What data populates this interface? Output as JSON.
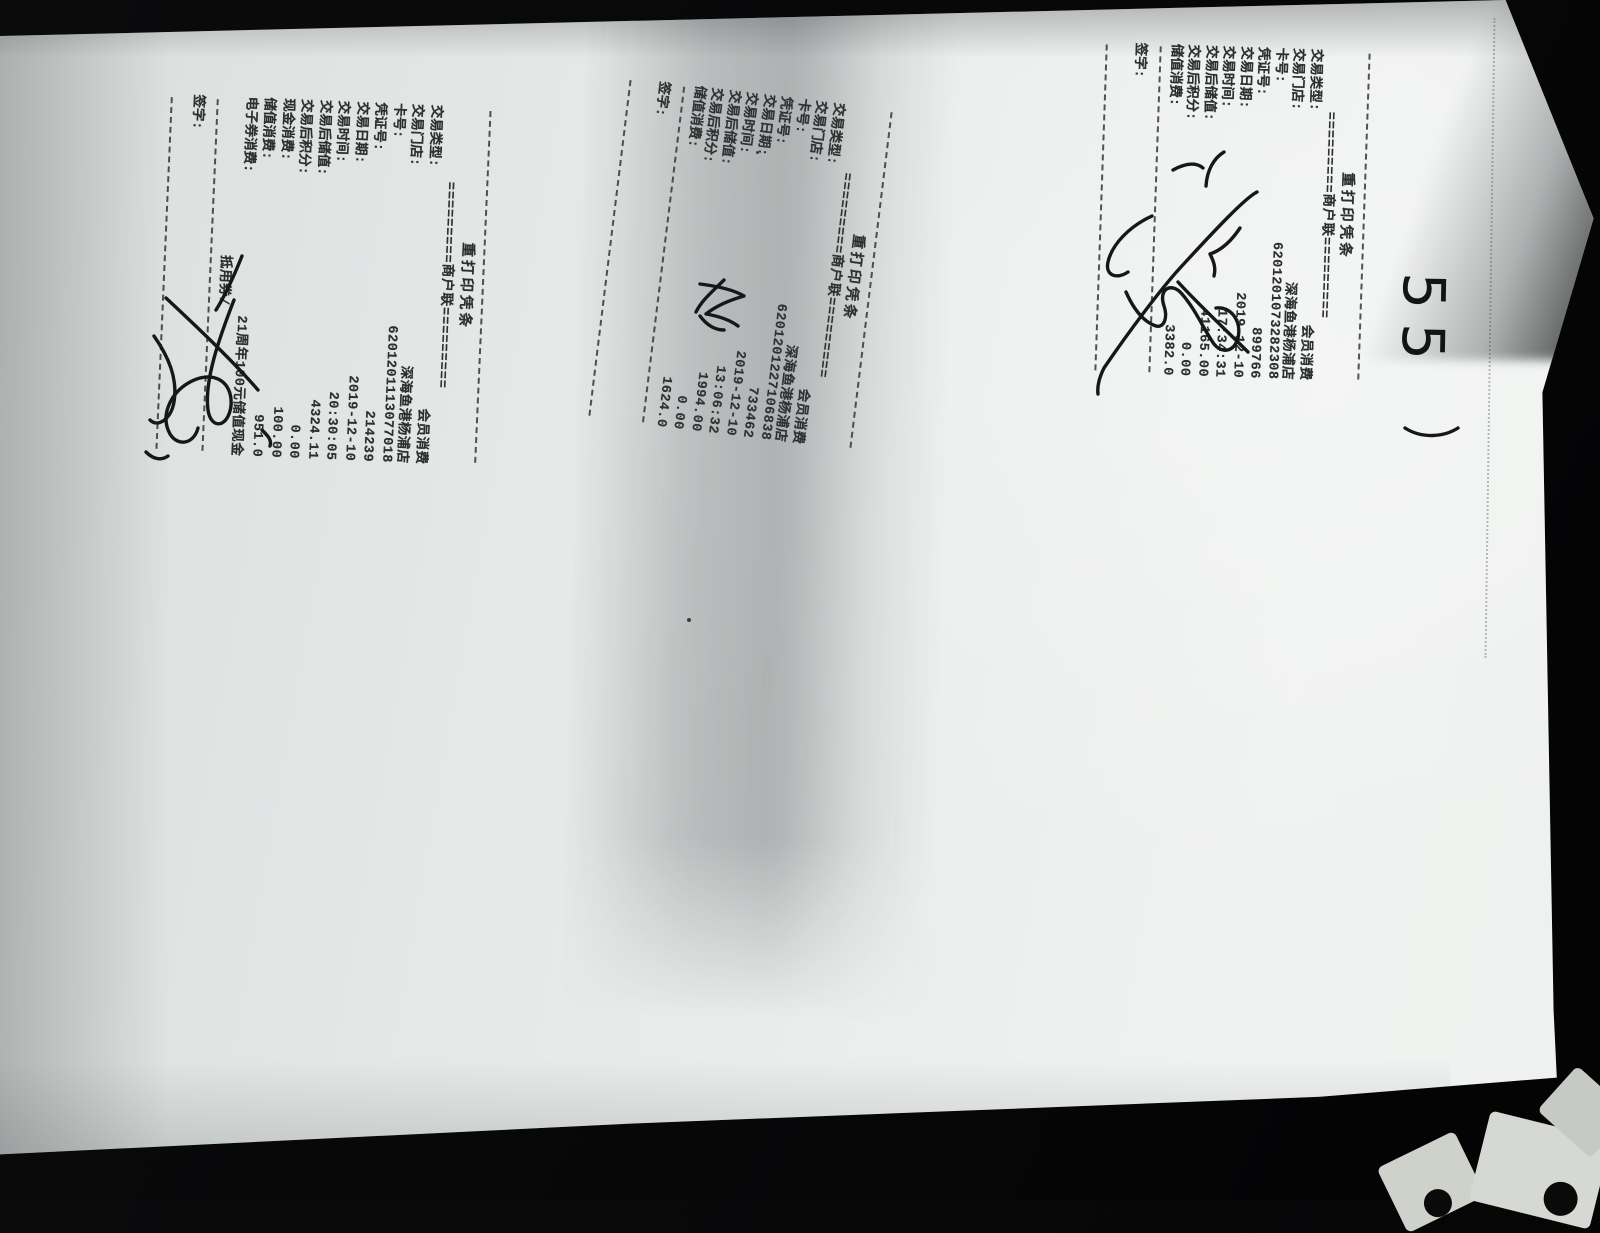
{
  "photo": {
    "background_color": "#0a0a0b",
    "paper_color": "#eaedec",
    "shadow_band_color": "#3a3f42",
    "ink_color": "#161718",
    "scrap_color": "#d3d6d0"
  },
  "annotations": {
    "handwritten_number": "55",
    "signature_note": "handwritten-signatures-on-sign-lines"
  },
  "receipts": [
    {
      "title": "重打印凭条",
      "copy_line": "=========商户联=========",
      "fields": [
        {
          "label": "交易类型:",
          "value": "会员消费"
        },
        {
          "label": "交易门店:",
          "value": "深海鱼港杨浦店"
        },
        {
          "label": "卡号:",
          "value": "6201201073282308"
        },
        {
          "label": "凭证号:",
          "value": "899766"
        },
        {
          "label": "交易日期:",
          "value": "2019-12-10"
        },
        {
          "label": "交易时间:",
          "value": "17:34:31"
        },
        {
          "label": "交易后储值:",
          "value": "41165.00"
        },
        {
          "label": "交易后积分:",
          "value": "0.00"
        },
        {
          "label": "储值消费:",
          "value": "3382.0"
        }
      ],
      "sign_label": "签字:"
    },
    {
      "title": "重打印凭条",
      "copy_line": "=========商户联=========",
      "fields": [
        {
          "label": "交易类型:",
          "value": "会员消费"
        },
        {
          "label": "交易门店:",
          "value": "深海鱼港杨浦店"
        },
        {
          "label": "卡号:",
          "value": "6201201227106838"
        },
        {
          "label": "凭证号:",
          "value": "733462"
        },
        {
          "label": "交易日期:",
          "value": "2019-12-10"
        },
        {
          "label": "交易时间:",
          "value": "13:06:32"
        },
        {
          "label": "交易后储值:",
          "value": "1994.00"
        },
        {
          "label": "交易后积分:",
          "value": "0.00"
        },
        {
          "label": "储值消费:",
          "value": "1624.0"
        }
      ],
      "sign_label": "签字:"
    },
    {
      "title": "重打印凭条",
      "copy_line": "=========商户联=========",
      "fields": [
        {
          "label": "交易类型:",
          "value": "会员消费"
        },
        {
          "label": "交易门店:",
          "value": "深海鱼港杨浦店"
        },
        {
          "label": "卡号:",
          "value": "6201201113077018"
        },
        {
          "label": "凭证号:",
          "value": "214239"
        },
        {
          "label": "交易日期:",
          "value": "2019-12-10"
        },
        {
          "label": "交易时间:",
          "value": "20:30:05"
        },
        {
          "label": "交易后储值:",
          "value": "4324.11"
        },
        {
          "label": "交易后积分:",
          "value": "0.00"
        },
        {
          "label": "现金消费:",
          "value": "100.00"
        },
        {
          "label": "储值消费:",
          "value": "951.0"
        },
        {
          "label": "电子券消费:",
          "value": "21周年100元储值现金"
        },
        {
          "label": "",
          "value": "抵用券/",
          "continuation": true
        }
      ],
      "sign_label": "签字:"
    }
  ]
}
